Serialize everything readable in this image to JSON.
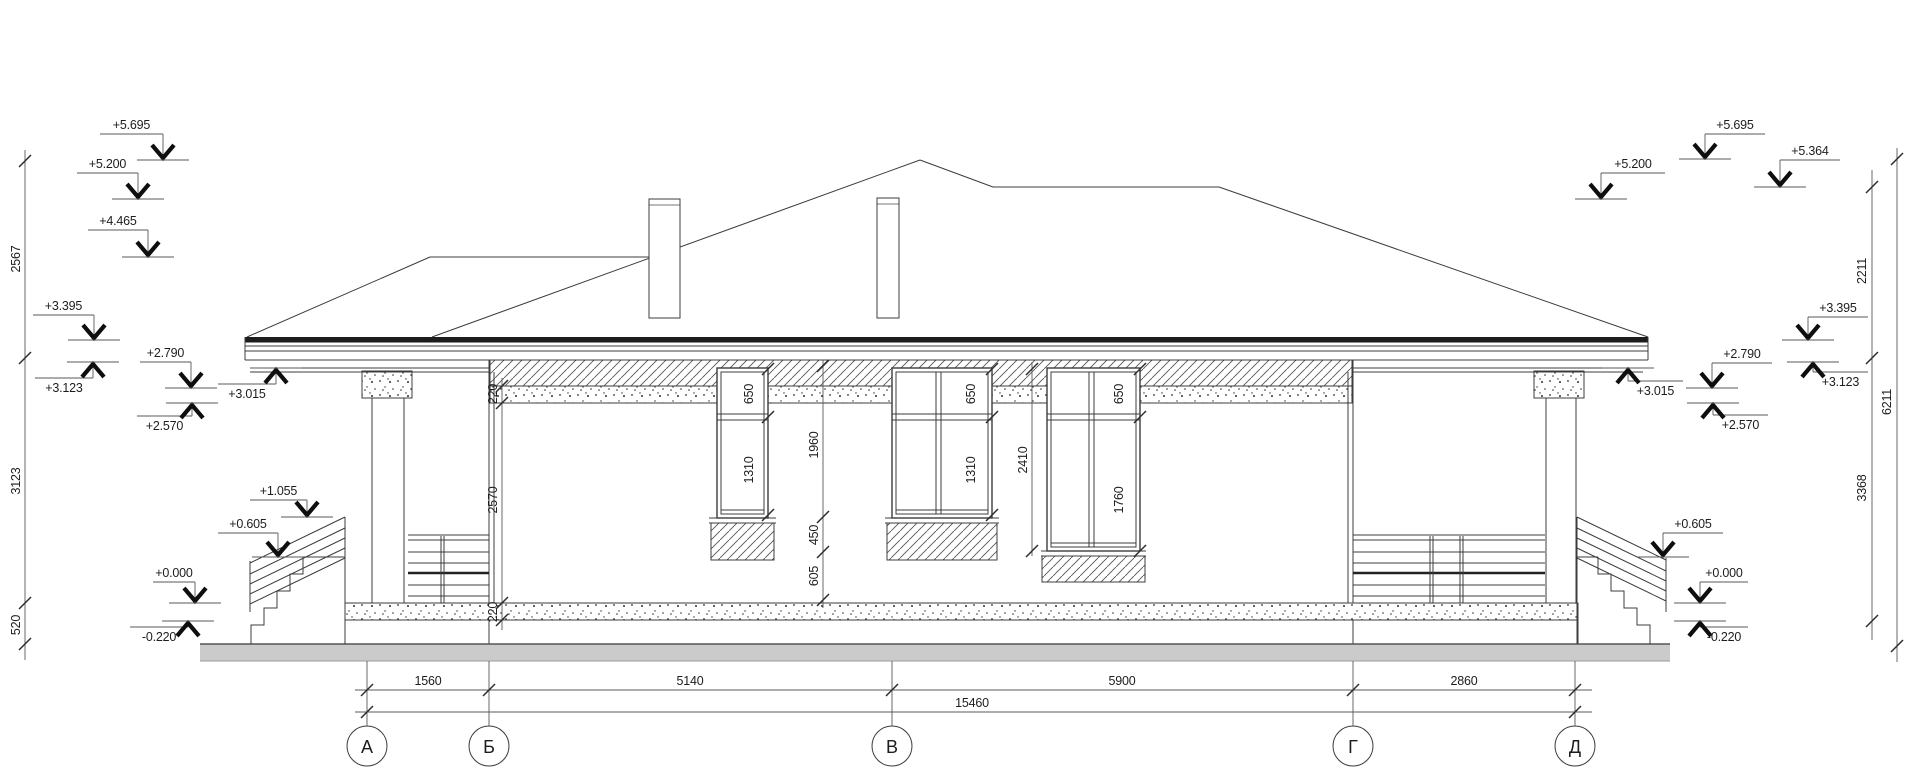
{
  "drawing_type": "building-elevation",
  "axis_labels": [
    "А",
    "Б",
    "В",
    "Г",
    "Д"
  ],
  "bottom_dims": [
    "1560",
    "5140",
    "5900",
    "2860"
  ],
  "total_dim": "15460",
  "side_dims_left": [
    "2567",
    "3123",
    "520"
  ],
  "side_dims_right": [
    "2211",
    "3368",
    "6211"
  ],
  "levels_left": [
    "+5.695",
    "+5.200",
    "+4.465",
    "+3.395",
    "+3.123",
    "+2.790",
    "+2.570",
    "+3.015",
    "+1.055",
    "+0.605",
    "+0.000",
    "-0.220"
  ],
  "levels_right": [
    "+5.200",
    "+5.695",
    "+5.364",
    "+3.395",
    "+2.790",
    "+3.123",
    "+3.015",
    "+2.570",
    "+0.605",
    "+0.000",
    "-0.220"
  ],
  "win": {
    "w1": [
      "650",
      "1310"
    ],
    "w2": [
      "650",
      "1310"
    ],
    "w3": [
      "650",
      "1760"
    ],
    "w3_total": "2410",
    "mid": [
      "1960",
      "450",
      "605"
    ],
    "corner": [
      "220",
      "2570",
      "220"
    ]
  },
  "colors": {
    "ground_strip": "#cbcbcb",
    "line": "#3c3c3c"
  }
}
